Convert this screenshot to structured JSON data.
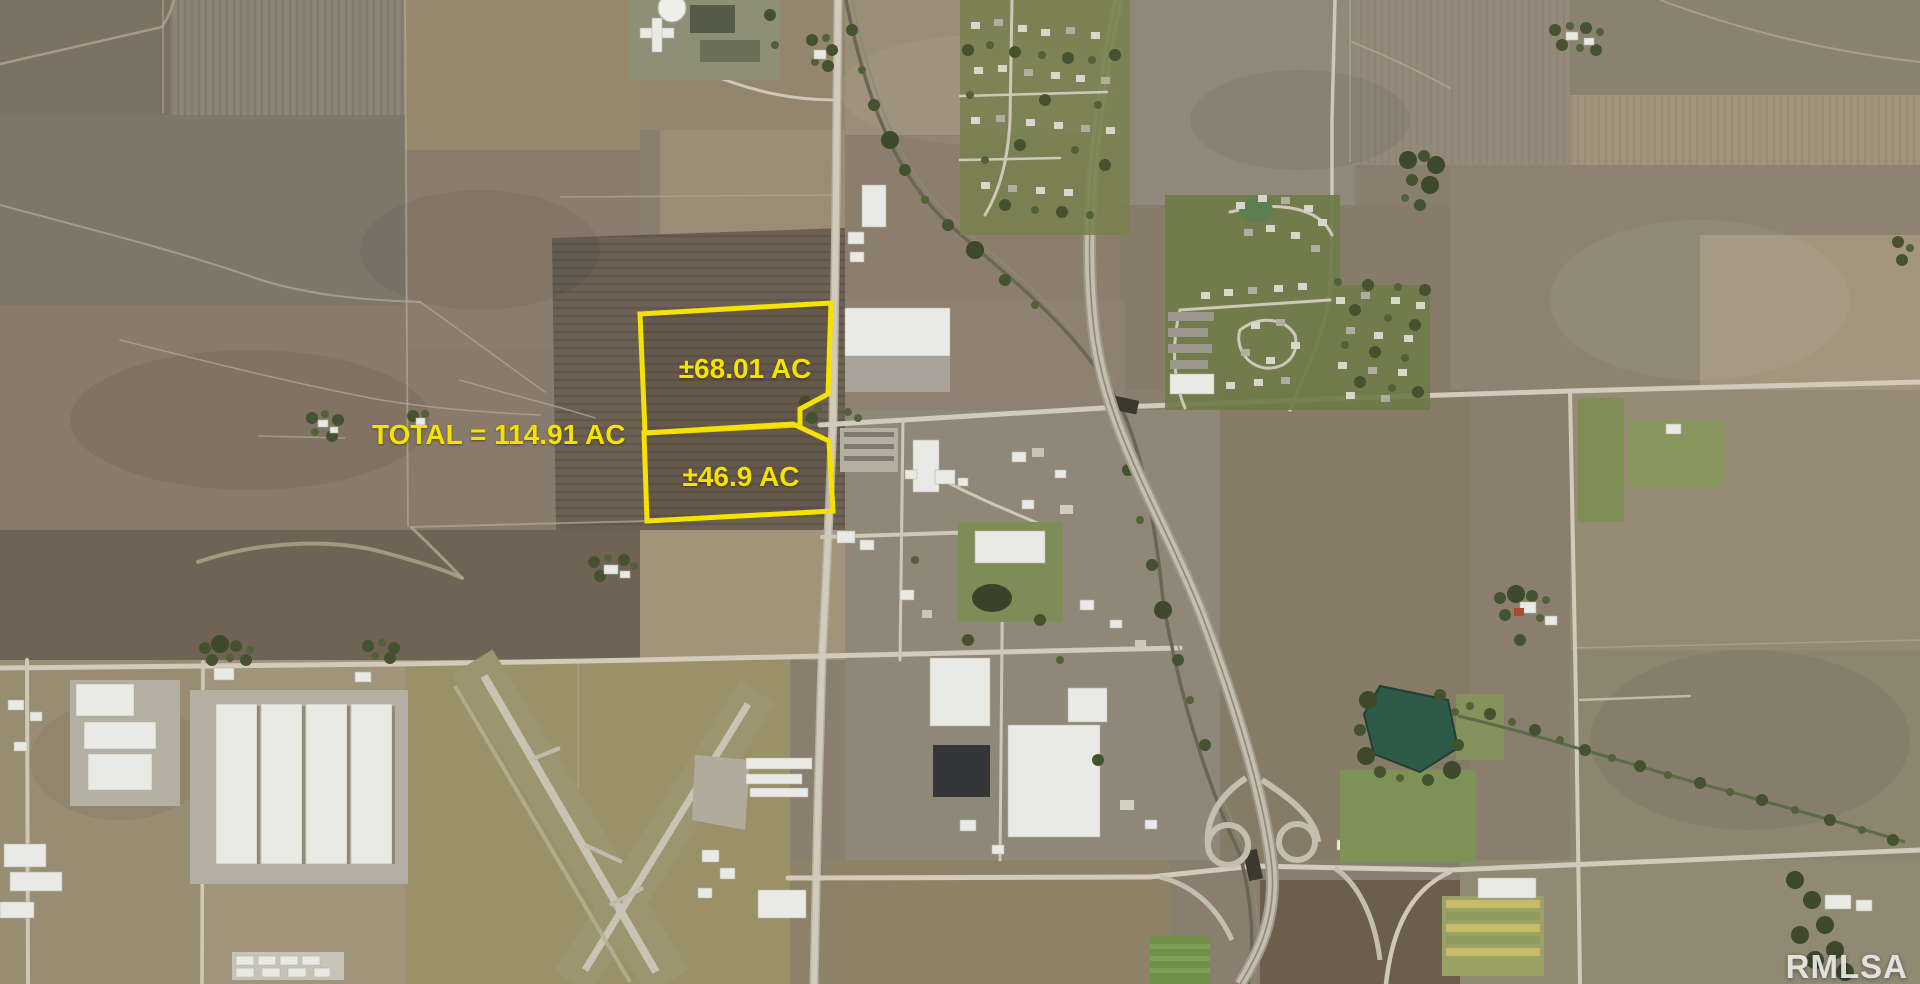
{
  "map": {
    "type": "aerial-satellite-photo",
    "description_visible_text_only": true
  },
  "annotations": {
    "outline_color": "#F5E203",
    "label_color": "#F5E203",
    "total": {
      "label": "TOTAL = 114.91 AC",
      "x": "372",
      "y": "444"
    },
    "parcel_upper": {
      "label": "±68.01 AC",
      "points": "640,314 831,303 828,394 800,409 800,425 645,433",
      "label_x": "745",
      "label_y": "378"
    },
    "parcel_lower": {
      "label": "±46.9 AC",
      "points": "644,433 793,424 829,441 833,511 647,521",
      "label_x": "741",
      "label_y": "486"
    }
  },
  "watermark": {
    "text": "RMLSA",
    "x": "1908",
    "y": "978"
  }
}
